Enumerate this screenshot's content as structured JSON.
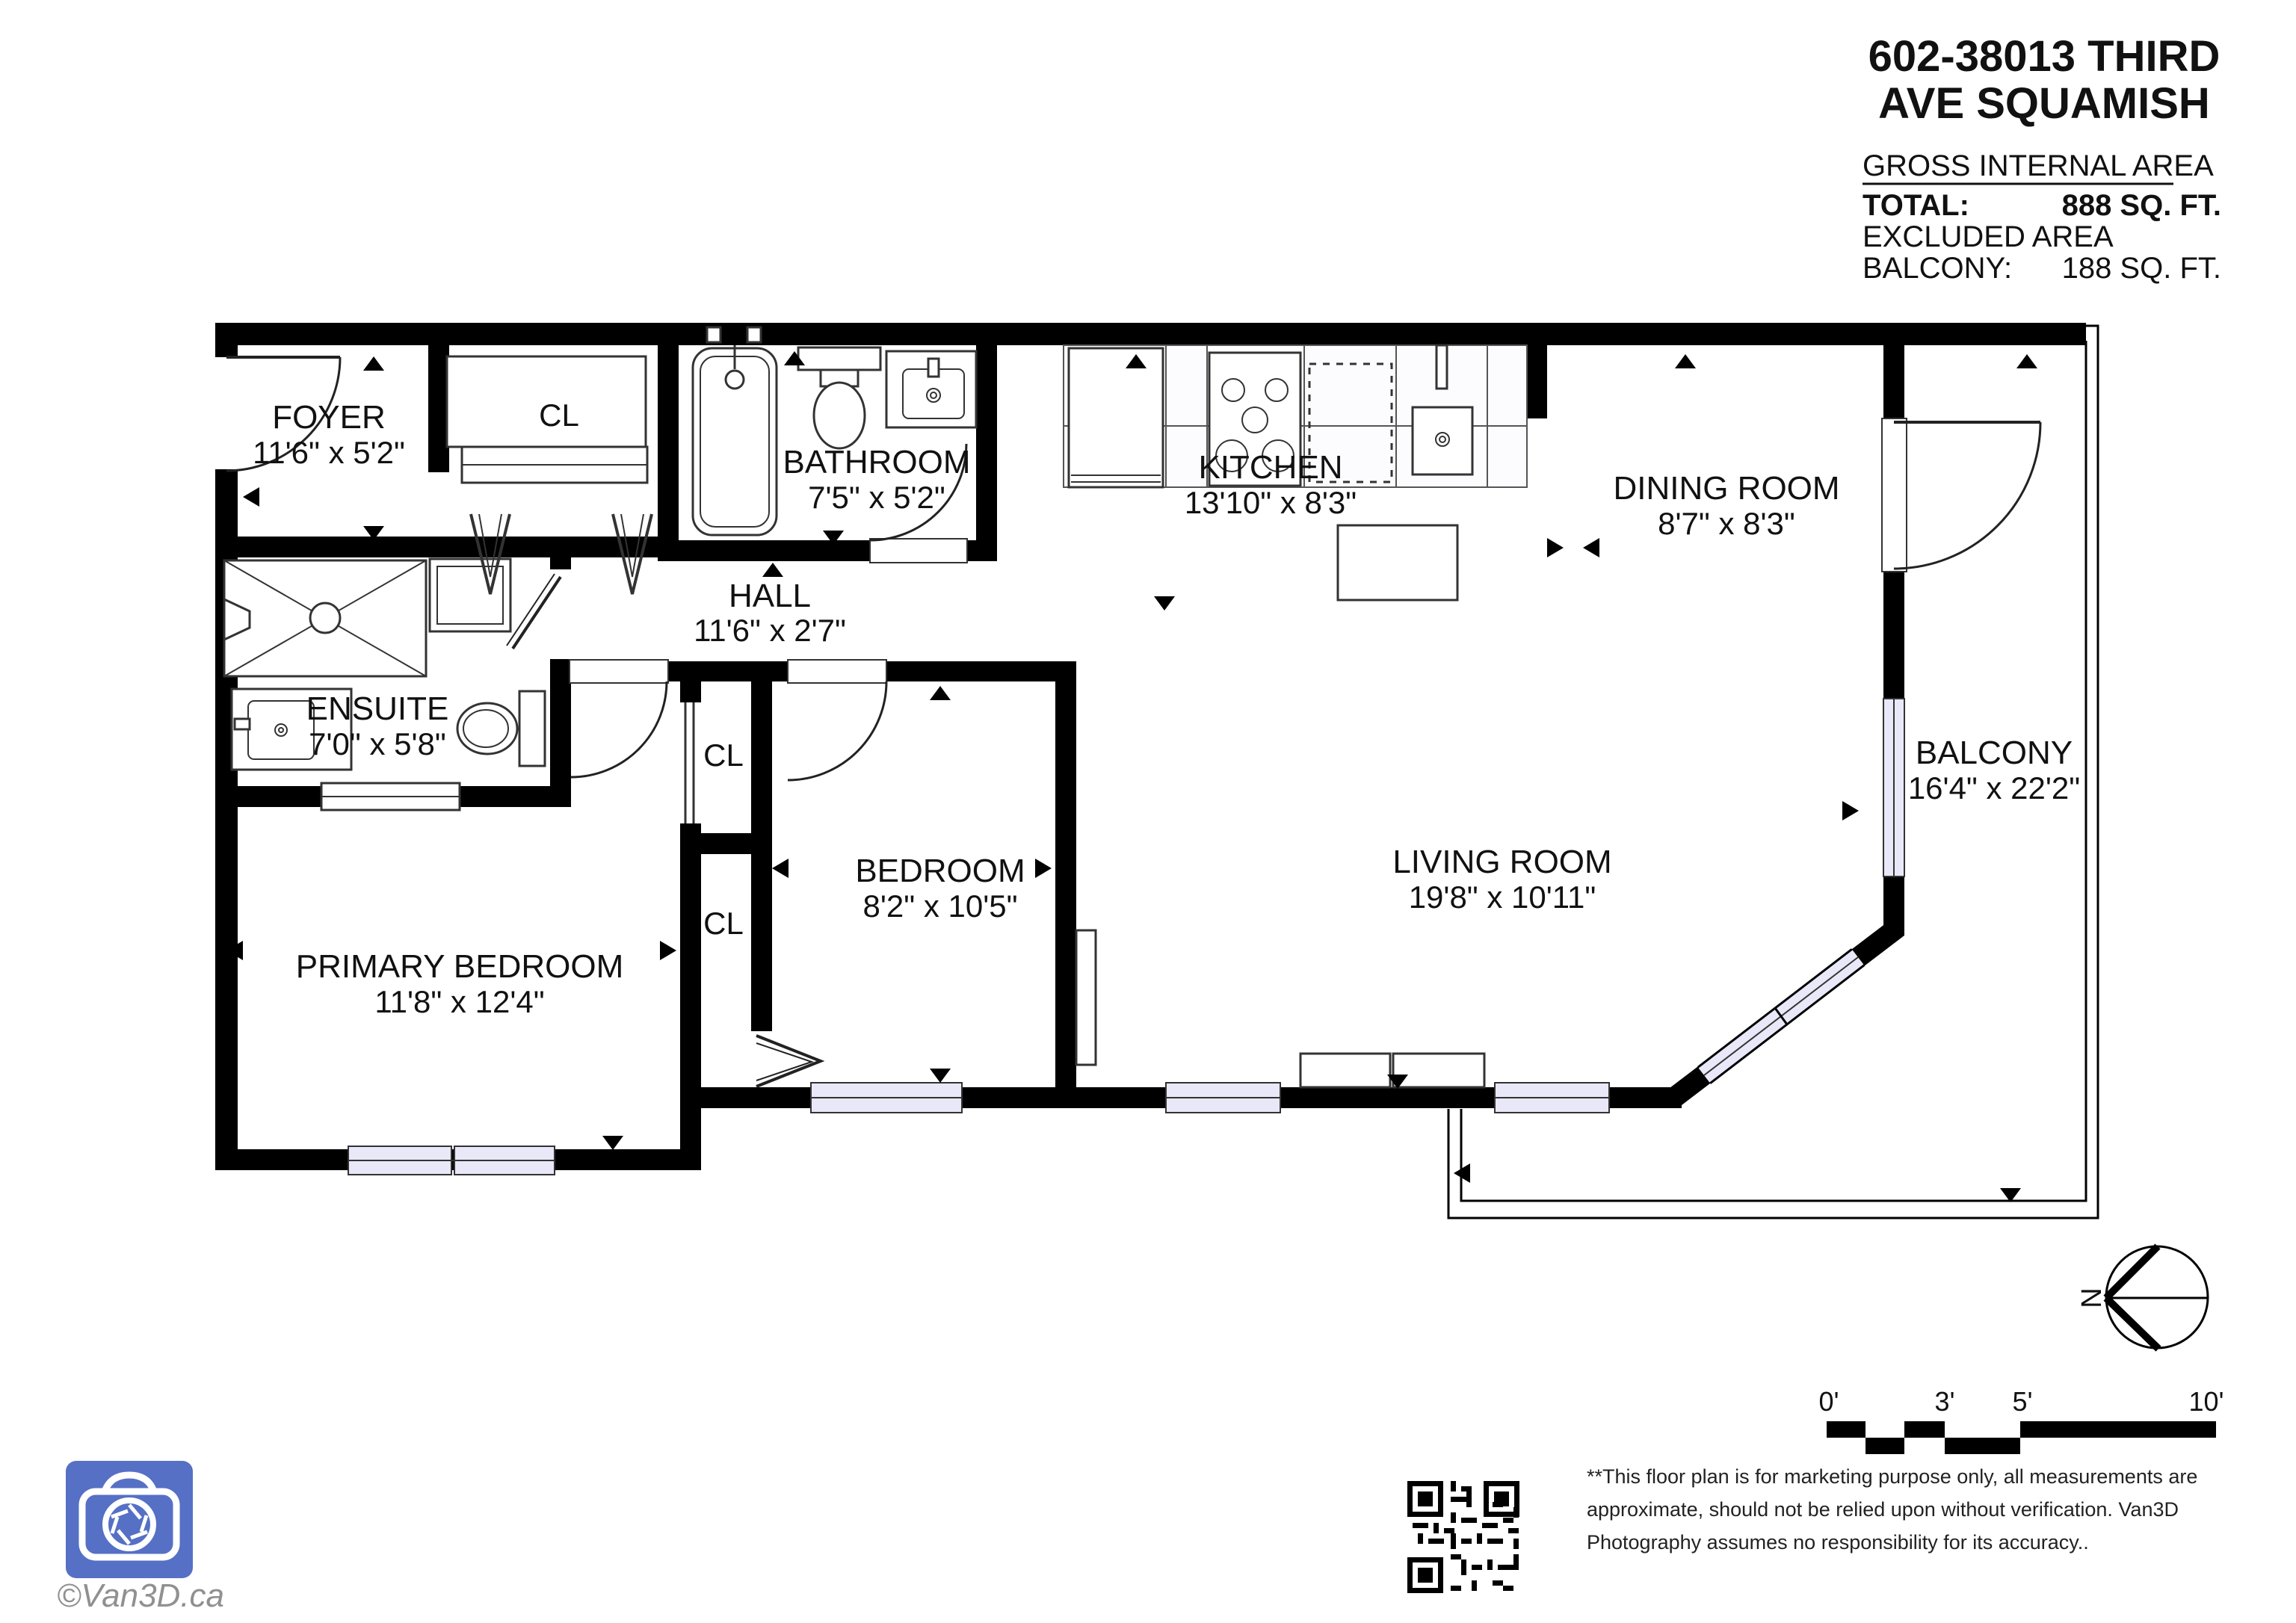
{
  "header": {
    "title_line1": "602-38013 THIRD",
    "title_line2": "AVE SQUAMISH",
    "area_heading": "GROSS INTERNAL AREA",
    "total_label": "TOTAL:",
    "total_value": "888 SQ. FT.",
    "excluded_label": "EXCLUDED AREA",
    "balcony_label": "BALCONY:",
    "balcony_value": "188 SQ. FT."
  },
  "rooms": {
    "foyer": {
      "name": "FOYER",
      "dims": "11'6\" x 5'2\""
    },
    "foyer_closet": {
      "name": "CL"
    },
    "bathroom": {
      "name": "BATHROOM",
      "dims": "7'5\" x 5'2\""
    },
    "hall": {
      "name": "HALL",
      "dims": "11'6\" x 2'7\""
    },
    "kitchen": {
      "name": "KITCHEN",
      "dims": "13'10\" x 8'3\""
    },
    "dining_room": {
      "name": "DINING ROOM",
      "dims": "8'7\" x 8'3\""
    },
    "balcony": {
      "name": "BALCONY",
      "dims": "16'4\" x 22'2\""
    },
    "living_room": {
      "name": "LIVING ROOM",
      "dims": "19'8\" x 10'11\""
    },
    "bedroom": {
      "name": "BEDROOM",
      "dims": "8'2\" x 10'5\""
    },
    "primary_bedroom": {
      "name": "PRIMARY BEDROOM",
      "dims": "11'8\" x 12'4\""
    },
    "ensuite": {
      "name": "ENSUITE",
      "dims": "7'0\" x 5'8\""
    },
    "closet_upper": {
      "name": "CL"
    },
    "closet_lower": {
      "name": "CL"
    }
  },
  "scale_bar": {
    "tick_0": "0'",
    "tick_3": "3'",
    "tick_5": "5'",
    "tick_10": "10'"
  },
  "compass": {
    "north": "N"
  },
  "footer": {
    "copyright": "©Van3D.ca",
    "disclaimer_line1": "**This floor plan is for marketing purpose only, all measurements are",
    "disclaimer_line2": "approximate, should not be relied upon without verification. Van3D",
    "disclaimer_line3": "Photography assumes no responsibility for its accuracy.."
  },
  "colors": {
    "wall": "#000000",
    "window_glass": "#E8E8F8",
    "logo_blue": "#5570C5",
    "copyright_gray": "#909090"
  }
}
